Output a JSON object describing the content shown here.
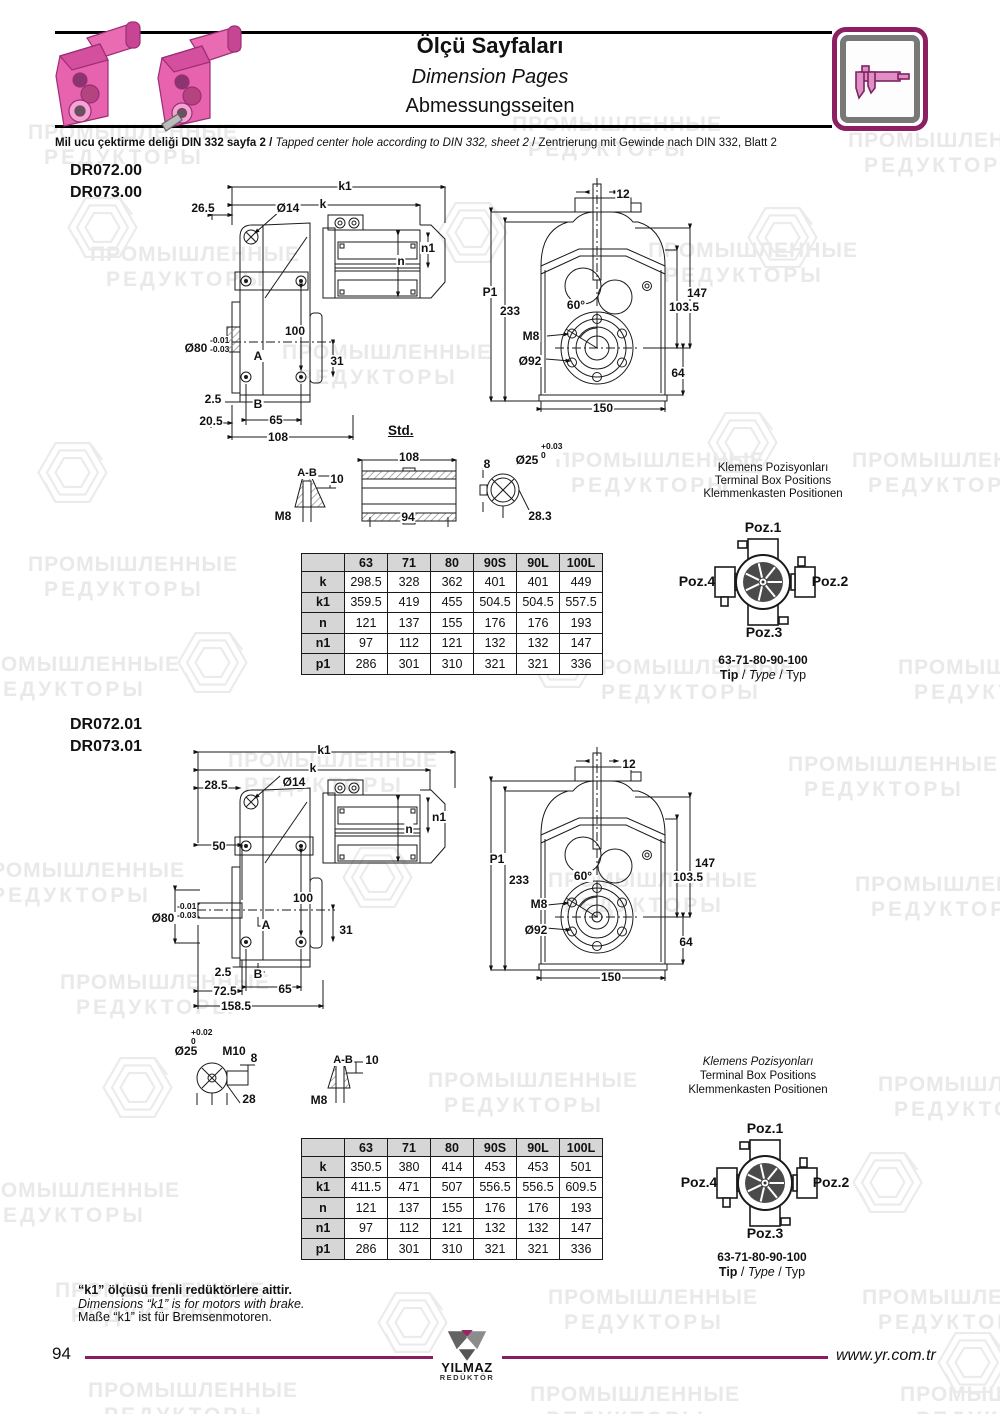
{
  "header": {
    "title_tr": "Ölçü Sayfaları",
    "title_en": "Dimension Pages",
    "title_de": "Abmessungsseiten",
    "note_tr": "Mil ucu çektirme deliği DIN 332 sayfa 2 /",
    "note_en": "Tapped center hole according to DIN 332, sheet 2",
    "note_sep": "/",
    "note_de": "Zentrierung mit Gewinde nach DIN 332, Blatt 2"
  },
  "watermark": {
    "line1": "ПРОМЫШЛЕННЫЕ",
    "line2": "РЕДУКТОРЫ"
  },
  "colors": {
    "accent": "#8d1f63",
    "motor_pink": "#e863ae",
    "table_header": "#d6d6d6"
  },
  "icons": {
    "header_icon": "caliper-icon",
    "logo": "yilmaz-y-logo"
  },
  "sections": [
    {
      "models": [
        "DR072.00",
        "DR073.00"
      ],
      "std": "Std.",
      "side": {
        "k1": "k1",
        "k": "k",
        "off": "26.5",
        "dia14": "Ø14",
        "n1": "n1",
        "n": "n",
        "h100": "100",
        "dia": "Ø80",
        "tol_hi": "-0.01",
        "tol_lo": "-0.03",
        "a": "A",
        "v31": "31",
        "v2_5": "2.5",
        "b": "B",
        "v20_5": "20.5",
        "v65": "65",
        "v108": "108"
      },
      "front": {
        "v12": "12",
        "p1": "P1",
        "v233": "233",
        "deg60": "60°",
        "m8": "M8",
        "dia92": "Ø92",
        "v147": "147",
        "v103_5": "103.5",
        "v64": "64",
        "v150": "150"
      },
      "detail": {
        "ab": "A-B",
        "v10": "10",
        "m8": "M8",
        "v108": "108",
        "v94": "94",
        "v8": "8",
        "dia25": "Ø25",
        "tol_hi": "+0.03",
        "tol_lo": "0",
        "v28_3": "28.3"
      },
      "table": {
        "headers": [
          "",
          "63",
          "71",
          "80",
          "90S",
          "90L",
          "100L"
        ],
        "rows": [
          [
            "k",
            "298.5",
            "328",
            "362",
            "401",
            "401",
            "449"
          ],
          [
            "k1",
            "359.5",
            "419",
            "455",
            "504.5",
            "504.5",
            "557.5"
          ],
          [
            "n",
            "121",
            "137",
            "155",
            "176",
            "176",
            "193"
          ],
          [
            "n1",
            "97",
            "112",
            "121",
            "132",
            "132",
            "147"
          ],
          [
            "p1",
            "286",
            "301",
            "310",
            "321",
            "321",
            "336"
          ]
        ]
      },
      "terminal": {
        "l1": "Klemens Pozisyonları",
        "l2": "Terminal Box Positions",
        "l3": "Klemmenkasten Positionen",
        "poz1": "Poz.1",
        "poz2": "Poz.2",
        "poz3": "Poz.3",
        "poz4": "Poz.4",
        "sizes": "63-71-80-90-100",
        "tip": "Tip",
        "type": "Type",
        "typ": "Typ",
        "sep": " / "
      }
    },
    {
      "models": [
        "DR072.01",
        "DR073.01"
      ],
      "side": {
        "k1": "k1",
        "k": "k",
        "off": "28.5",
        "dia14": "Ø14",
        "n1": "n1",
        "n": "n",
        "v50": "50",
        "h100": "100",
        "dia": "Ø80",
        "tol_hi": "-0.01",
        "tol_lo": "-0.03",
        "a": "A",
        "v31": "31",
        "v2_5": "2.5",
        "b": "B",
        "v72_5": "72.5",
        "v65": "65",
        "v158_5": "158.5"
      },
      "front": {
        "v12": "12",
        "p1": "P1",
        "v233": "233",
        "deg60": "60°",
        "m8": "M8",
        "dia92": "Ø92",
        "v147": "147",
        "v103_5": "103.5",
        "v64": "64",
        "v150": "150"
      },
      "detail": {
        "tol_hi": "+0.02",
        "tol_lo": "0",
        "dia25": "Ø25",
        "m10": "M10",
        "v8": "8",
        "v28": "28",
        "ab": "A-B",
        "v10": "10",
        "m8": "M8"
      },
      "table": {
        "headers": [
          "",
          "63",
          "71",
          "80",
          "90S",
          "90L",
          "100L"
        ],
        "rows": [
          [
            "k",
            "350.5",
            "380",
            "414",
            "453",
            "453",
            "501"
          ],
          [
            "k1",
            "411.5",
            "471",
            "507",
            "556.5",
            "556.5",
            "609.5"
          ],
          [
            "n",
            "121",
            "137",
            "155",
            "176",
            "176",
            "193"
          ],
          [
            "n1",
            "97",
            "112",
            "121",
            "132",
            "132",
            "147"
          ],
          [
            "p1",
            "286",
            "301",
            "310",
            "321",
            "321",
            "336"
          ]
        ]
      },
      "terminal": {
        "l1": "Klemens Pozisyonları",
        "l2": "Terminal Box Positions",
        "l3": "Klemmenkasten Positionen",
        "poz1": "Poz.1",
        "poz2": "Poz.2",
        "poz3": "Poz.3",
        "poz4": "Poz.4",
        "sizes": "63-71-80-90-100",
        "tip": "Tip",
        "type": "Type",
        "typ": "Typ",
        "sep": " / "
      }
    }
  ],
  "footnote": {
    "tr": "“k1” ölçüsü frenli redüktörlere aittir.",
    "en": "Dimensions “k1” is for motors with brake.",
    "de": "Maße “k1” ist für Bremsenmotoren."
  },
  "footer": {
    "page": "94",
    "url": "www.yr.com.tr",
    "logo_name": "YILMAZ",
    "logo_sub": "REDÜKTÖR"
  }
}
